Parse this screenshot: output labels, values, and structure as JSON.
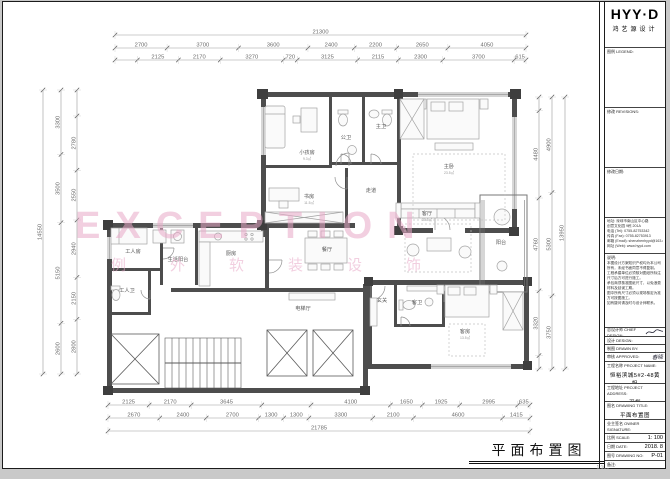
{
  "watermark": {
    "text": "EXCEPTION",
    "sub": "例外软装设饰",
    "color": "#e7a7c6"
  },
  "caption": {
    "title": "平面布置图",
    "scale": "1:100"
  },
  "title_block": {
    "logo": {
      "main": "HYY·D",
      "sub": "鸿艺源设计"
    },
    "legend_label": "图例 LEGEND:",
    "revisions_label": "修改 REVISIONS:",
    "revision_date_label": "修改日期:",
    "contact_lines": [
      "地址: 深圳市南山区中心路",
      "创意文化园 9栋 201A",
      "电话 (Tel): 0755-82753342",
      "传真 (Fax): 0755-82753913",
      "邮箱 (Email): shenzhenhyyd@163.com",
      "网址 (Web): www.hyyd.com"
    ],
    "notes_label": "说明:",
    "notes": [
      "本图设计方案知识产权均为本公司",
      "所有，未经书面同意不得复制。",
      "工程承建单位必须核对图纸所标注",
      "尺寸后方可进行施工。",
      "承包商须核准图纸尺寸，以免浪费",
      "材料及延误工期。",
      "图中所有尺寸必须以现场核定为准",
      "方可按图施工。",
      "如有疑问请及时与设计师联系。"
    ],
    "chief_label": "总设计师 CHIEF DESIGN:",
    "design_label": "设计 DESIGN:",
    "drawn_label": "制图 DRAWN BY:",
    "approved_label": "审核 APPROVED:",
    "approved_value": "春晓",
    "project_name_label": "工程名称 PROJECT NAME:",
    "project_name": "恒裕滨城5#2-48黄姐",
    "project_addr_label": "工程地址 PROJECT ADDRESS:",
    "project_addr": "深圳",
    "drawing_title_label": "图名 DRAWING TITLE:",
    "drawing_title": "平面布置图",
    "owner_label": "业主签名 OWNER SIGNATURE:",
    "scale_label": "比例 SCALE:",
    "scale_value": "1: 100",
    "date_label": "日期 DATE:",
    "date_value": "2018. 8",
    "no_label": "图号 DRAWING NO:",
    "no_value": "P-01",
    "extra_label": "备注:"
  },
  "plan": {
    "rooms": [
      {
        "n": "小孩房",
        "s": "9.3㎡",
        "x": 304,
        "y": 152
      },
      {
        "n": "书房",
        "s": "11.5㎡",
        "x": 306,
        "y": 196
      },
      {
        "n": "公卫",
        "s": "",
        "x": 343,
        "y": 137
      },
      {
        "n": "主卫",
        "s": "",
        "x": 378,
        "y": 126
      },
      {
        "n": "走道",
        "s": "",
        "x": 368,
        "y": 190
      },
      {
        "n": "主卧",
        "s": "23.5㎡",
        "x": 446,
        "y": 166
      },
      {
        "n": "客厅",
        "s": "30.5㎡",
        "x": 424,
        "y": 213
      },
      {
        "n": "阳台",
        "s": "",
        "x": 498,
        "y": 242
      },
      {
        "n": "餐厅",
        "s": "",
        "x": 324,
        "y": 249
      },
      {
        "n": "厨房",
        "s": "",
        "x": 228,
        "y": 253
      },
      {
        "n": "生活阳台",
        "s": "",
        "x": 175,
        "y": 259
      },
      {
        "n": "工人房",
        "s": "",
        "x": 130,
        "y": 251
      },
      {
        "n": "工人卫",
        "s": "",
        "x": 124,
        "y": 290
      },
      {
        "n": "电梯厅",
        "s": "",
        "x": 300,
        "y": 308
      },
      {
        "n": "玄关",
        "s": "",
        "x": 379,
        "y": 300
      },
      {
        "n": "客卫",
        "s": "",
        "x": 414,
        "y": 302
      },
      {
        "n": "客房",
        "s": "13.5㎡",
        "x": 462,
        "y": 331
      }
    ],
    "dim_rows": [
      {
        "dir": "h",
        "pos": 33,
        "from": 112,
        "to": 523,
        "segs": [
          {
            "v": 21300
          }
        ]
      },
      {
        "dir": "h",
        "pos": 46,
        "from": 112,
        "to": 523,
        "segs": [
          {
            "v": 2700
          },
          {
            "v": 3700
          },
          {
            "v": 3600
          },
          {
            "v": 2400
          },
          {
            "v": 2200
          },
          {
            "v": 2650
          },
          {
            "v": 4050
          }
        ]
      },
      {
        "dir": "h",
        "pos": 58,
        "from": 112,
        "to": 523,
        "segs": [
          {
            "v": 1160,
            "blank": true
          },
          {
            "v": 2125
          },
          {
            "v": 2170
          },
          {
            "v": 3270
          },
          {
            "v": 720
          },
          {
            "v": 3125
          },
          {
            "v": 2115
          },
          {
            "v": 2300
          },
          {
            "v": 3700
          },
          {
            "v": 615
          }
        ]
      },
      {
        "dir": "h",
        "pos": 403,
        "from": 105,
        "to": 527,
        "segs": [
          {
            "v": 2125
          },
          {
            "v": 2170
          },
          {
            "v": 3645
          },
          {
            "v": 2540,
            "blank": true
          },
          {
            "v": 4100
          },
          {
            "v": 1650
          },
          {
            "v": 1925
          },
          {
            "v": 2995
          },
          {
            "v": 635
          }
        ]
      },
      {
        "dir": "h",
        "pos": 416,
        "from": 105,
        "to": 527,
        "segs": [
          {
            "v": 2670
          },
          {
            "v": 2400
          },
          {
            "v": 2700
          },
          {
            "v": 1300
          },
          {
            "v": 1300
          },
          {
            "v": 3300
          },
          {
            "v": 2100
          },
          {
            "v": 4600
          },
          {
            "v": 1415
          }
        ]
      },
      {
        "dir": "h",
        "pos": 429,
        "from": 105,
        "to": 527,
        "segs": [
          {
            "v": 21785
          }
        ]
      },
      {
        "dir": "v",
        "pos": 40,
        "from": 88,
        "to": 372,
        "segs": [
          {
            "v": 14550
          }
        ]
      },
      {
        "dir": "v",
        "pos": 58,
        "from": 88,
        "to": 372,
        "segs": [
          {
            "v": 3300
          },
          {
            "v": 3500
          },
          {
            "v": 5150
          },
          {
            "v": 2600
          }
        ]
      },
      {
        "dir": "v",
        "pos": 74,
        "from": 88,
        "to": 372,
        "segs": [
          {
            "v": 1330,
            "blank": true
          },
          {
            "v": 2780
          },
          {
            "v": 2550
          },
          {
            "v": 2940
          },
          {
            "v": 2150
          },
          {
            "v": 2800
          }
        ]
      },
      {
        "dir": "v",
        "pos": 536,
        "from": 95,
        "to": 367,
        "segs": [
          {
            "v": 700,
            "blank": true
          },
          {
            "v": 4480
          },
          {
            "v": 4760
          },
          {
            "v": 3320
          },
          {
            "v": 690,
            "blank": true
          }
        ]
      },
      {
        "dir": "v",
        "pos": 549,
        "from": 95,
        "to": 367,
        "segs": [
          {
            "v": 4900
          },
          {
            "v": 5300
          },
          {
            "v": 3750
          }
        ]
      },
      {
        "dir": "v",
        "pos": 562,
        "from": 95,
        "to": 367,
        "segs": [
          {
            "v": 13950
          }
        ]
      }
    ]
  }
}
